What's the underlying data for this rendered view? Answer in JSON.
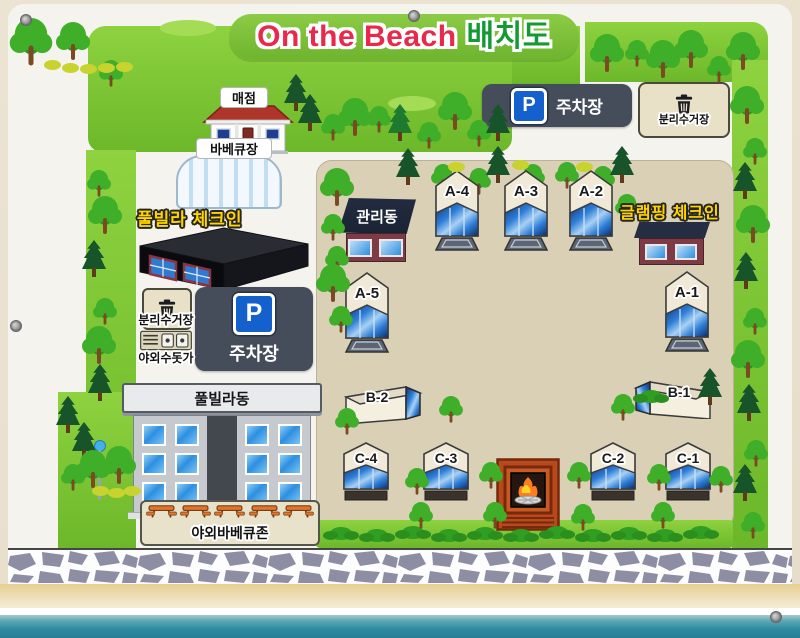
{
  "title": {
    "english": "On the Beach",
    "korean": "배치도"
  },
  "signs": {
    "parking_top": {
      "symbol": "P",
      "label": "주차장"
    },
    "recycling_top": {
      "label": "분리수거장"
    },
    "store": "매점",
    "bbq_hall": "바베큐장",
    "pool_villa_checkin": "풀빌라 체크인",
    "recycling_left": "분리수거장",
    "outdoor_sink": "야외수돗가",
    "parking_left": {
      "symbol": "P",
      "label": "주차장"
    },
    "pool_villa_building": "풀빌라동",
    "outdoor_bbq_zone": "야외바베큐존",
    "admin_building": "관리동",
    "glamping_checkin": "글램핑 체크인"
  },
  "sites": {
    "a1": "A-1",
    "a2": "A-2",
    "a3": "A-3",
    "a4": "A-4",
    "a5": "A-5",
    "b1": "B-1",
    "b2": "B-2",
    "c1": "C-1",
    "c2": "C-2",
    "c3": "C-3",
    "c4": "C-4"
  },
  "colors": {
    "banner_green": "#7cc13e",
    "title_red": "#e8294b",
    "title_green": "#149a33",
    "grass": "#7dc832",
    "camp_sand": "#d9d0b5",
    "sea": "#2b8399",
    "label_yellow": "#ffd400",
    "sign_dark": "#454d5b",
    "parking_blue": "#1460cc"
  }
}
